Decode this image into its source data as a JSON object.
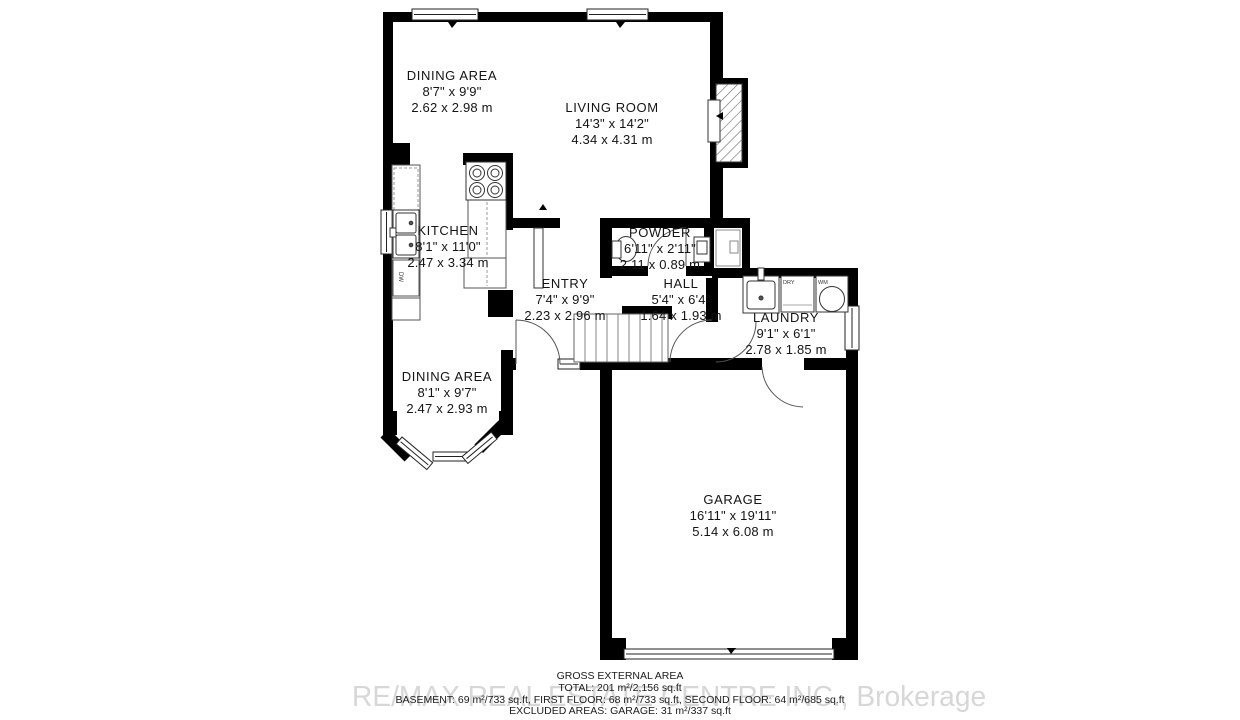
{
  "watermark": "RE/MAX REAL ESTATE CENTRE INC., Brokerage",
  "rooms": [
    {
      "name": "DINING AREA",
      "imperial": "8'7\" x 9'9\"",
      "metric": "2.62 x 2.98 m"
    },
    {
      "name": "LIVING ROOM",
      "imperial": "14'3\" x 14'2\"",
      "metric": "4.34 x 4.31 m"
    },
    {
      "name": "KITCHEN",
      "imperial": "8'1\" x 11'0\"",
      "metric": "2.47 x 3.34 m"
    },
    {
      "name": "POWDER",
      "imperial": "6'11\" x 2'11\"",
      "metric": "2.11 x 0.89 m"
    },
    {
      "name": "ENTRY",
      "imperial": "7'4\" x 9'9\"",
      "metric": "2.23 x 2.96 m"
    },
    {
      "name": "HALL",
      "imperial": "5'4\" x 6'4\"",
      "metric": "1.64 x 1.93 m"
    },
    {
      "name": "LAUNDRY",
      "imperial": "9'1\" x 6'1\"",
      "metric": "2.78 x 1.85 m"
    },
    {
      "name": "DINING AREA",
      "imperial": "8'1\" x 9'7\"",
      "metric": "2.47 x 2.93 m"
    },
    {
      "name": "GARAGE",
      "imperial": "16'11\" x 19'11\"",
      "metric": "5.14 x 6.08 m"
    }
  ],
  "appliances": {
    "dishwasher": "DW",
    "dryer": "DRY",
    "washer": "WM"
  },
  "footer": {
    "title": "GROSS EXTERNAL AREA",
    "total": "TOTAL: 201 m²/2,156 sq.ft",
    "floors": "BASEMENT: 69 m²/733 sq.ft, FIRST FLOOR: 68 m²/733 sq.ft, SECOND FLOOR: 64 m²/685 sq.ft",
    "excluded": "EXCLUDED AREAS: GARAGE: 31 m²/337 sq.ft"
  }
}
